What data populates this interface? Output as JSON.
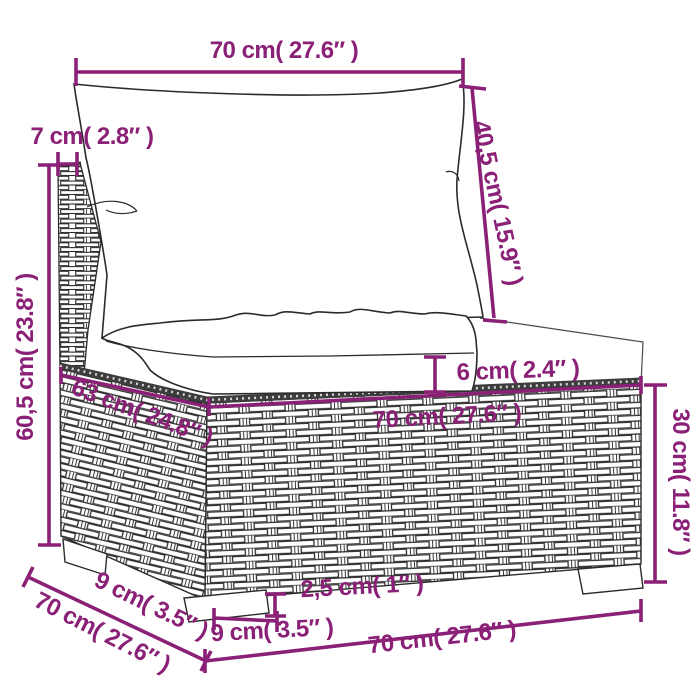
{
  "page": {
    "background": "#ffffff",
    "accent_color": "#8B2077",
    "line_color": "#2b2b2b"
  },
  "dimensions": {
    "top_width": "70 cm( 27.6″ )",
    "back_post_width": "7 cm( 2.8″ )",
    "total_height": "60,5 cm( 23.8″ )",
    "back_cushion_height": "40,5 cm( 15.9″ )",
    "seat_cushion_thickness": "6 cm( 2.4″ )",
    "base_top_depth": "63 cm( 24.8″ )",
    "base_top_width": "70 cm( 27.6″ )",
    "base_height": "30 cm( 11.8″ )",
    "foot_height": "2,5 cm( 1″ )",
    "foot_width": "9 cm( 3.5″ )",
    "foot_depth": "9 cm( 3.5″ )",
    "base_depth": "70 cm( 27.6″ )",
    "base_bottom_width": "70 cm( 27.6″ )"
  }
}
